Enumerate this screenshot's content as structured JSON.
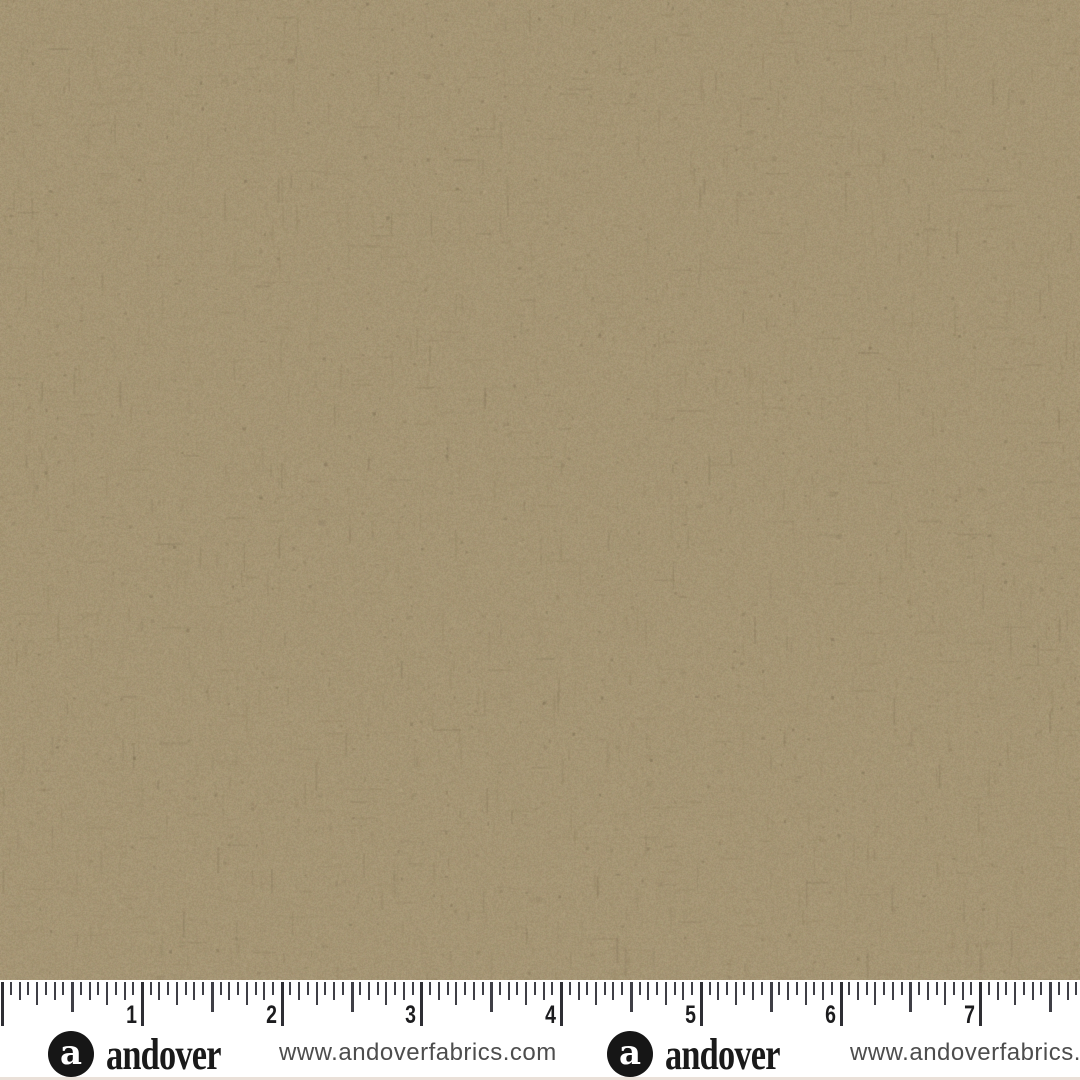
{
  "fabric": {
    "description": "tan khaki woven cottage-cloth texture swatch",
    "base_color": "#a59574",
    "dark_fleck_color": "#6f6148",
    "mid_fleck_color": "#877757",
    "light_fleck_color": "#c4b594",
    "width_px": 1080,
    "height_px": 980
  },
  "ruler": {
    "origin_x": 2.3,
    "pixels_per_inch": 139.7,
    "divisions_per_inch": 16,
    "unit_labels": [
      "1",
      "2",
      "3",
      "4",
      "5",
      "6",
      "7"
    ],
    "tick_color": "#3f3f46",
    "number_color": "#1c1c1e"
  },
  "branding": {
    "logo_letter": "a",
    "wordmark": "andover",
    "url": "www.andoverfabrics.com",
    "logo_bg_color": "#161616",
    "logo_letter_color": "#ffffff",
    "wordmark_color": "#1a1a1a",
    "url_color": "#4d4d4d"
  },
  "footer": {
    "background_color": "#ffffff",
    "bottom_line_color": "#eae0d8"
  }
}
